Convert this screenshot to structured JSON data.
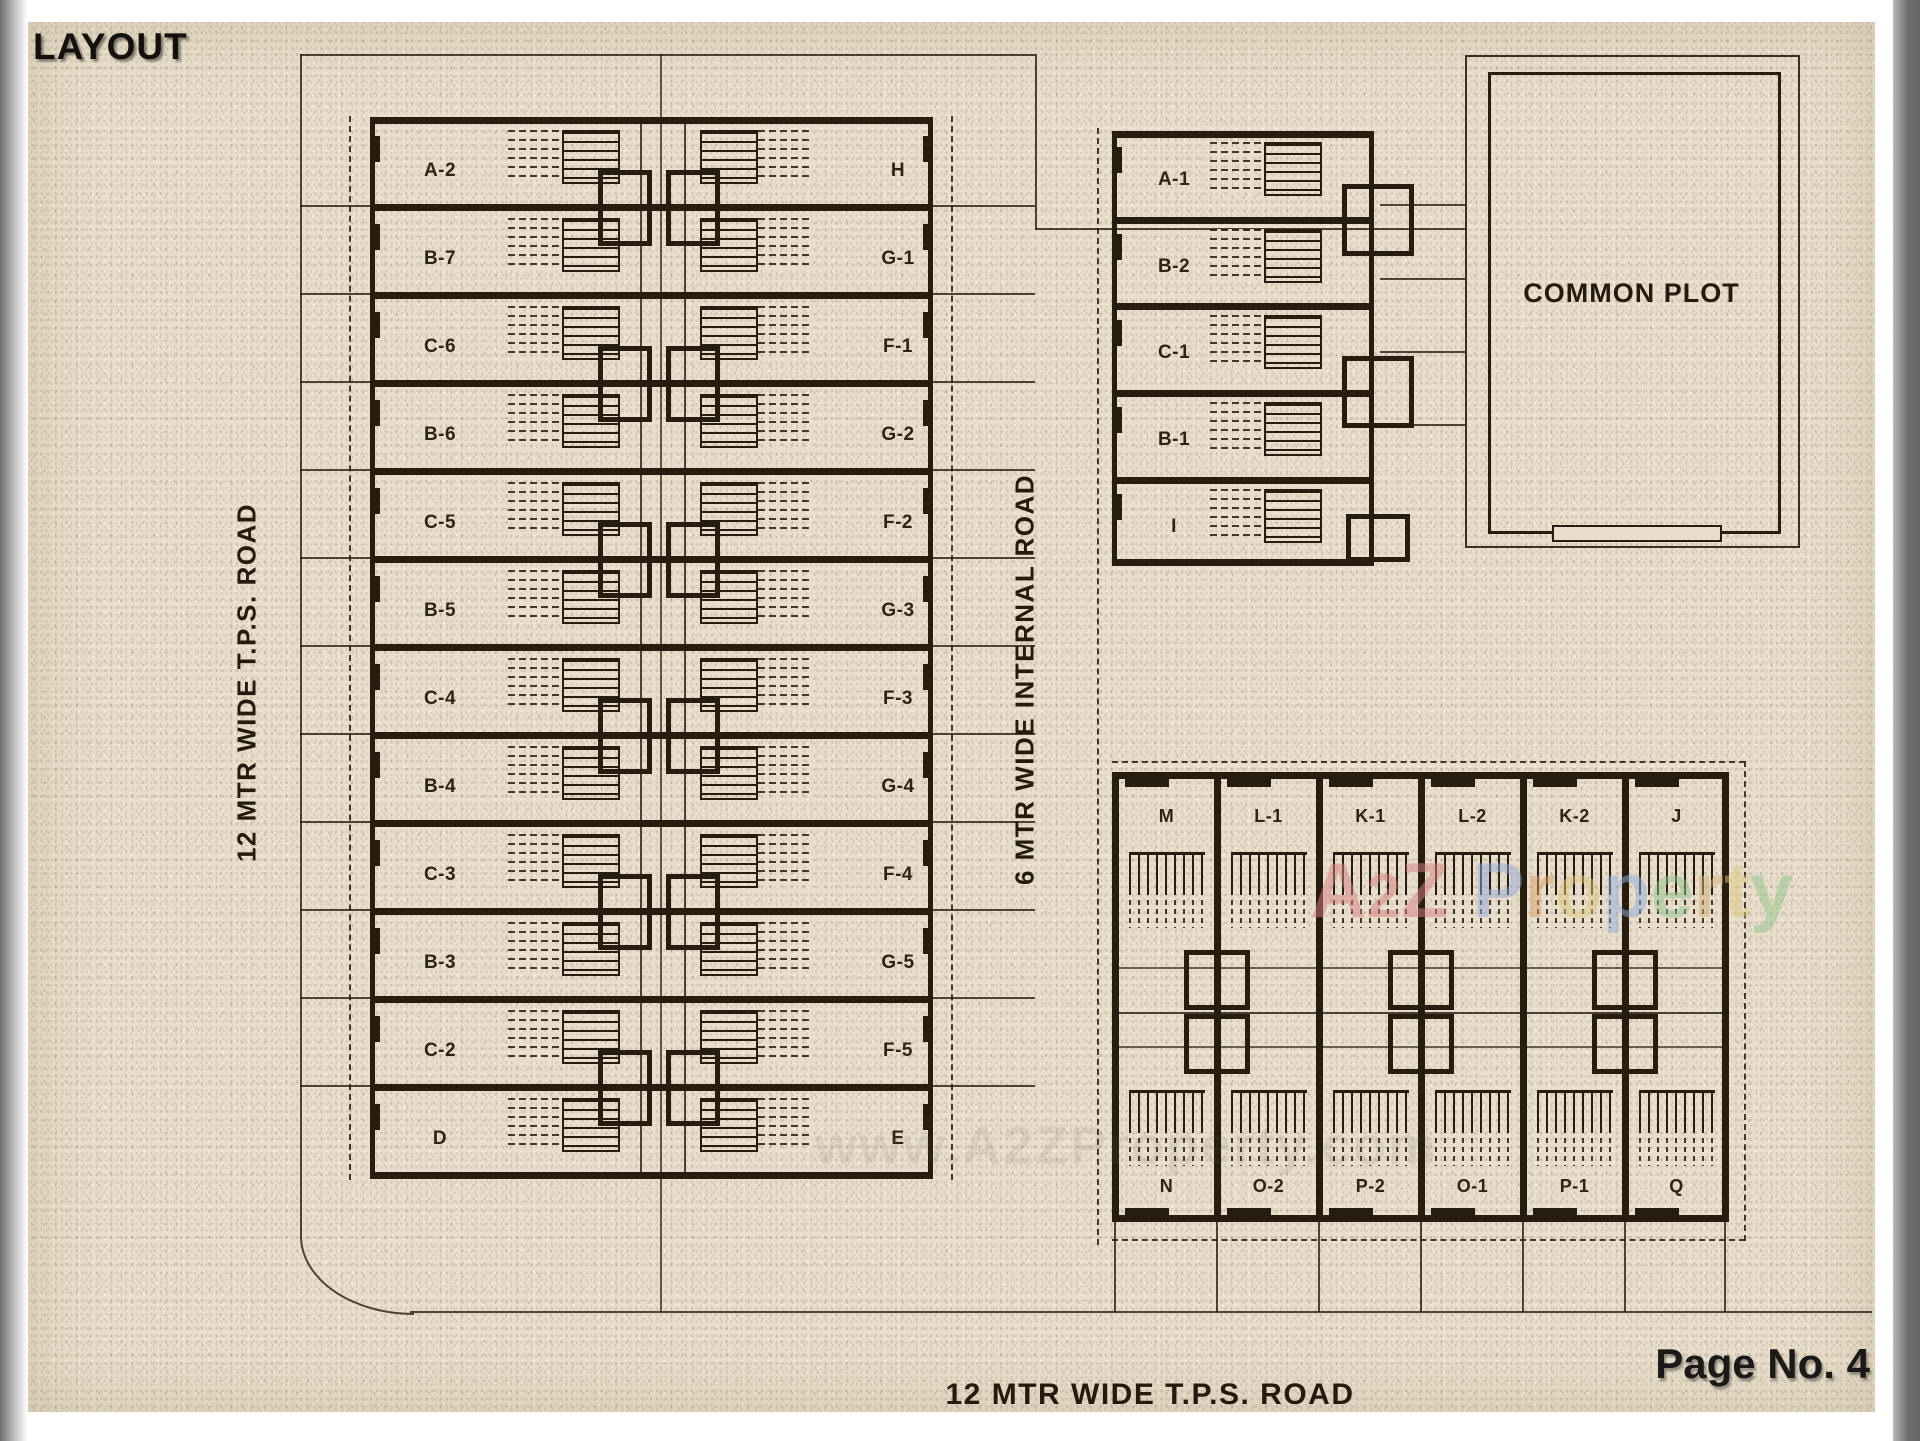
{
  "page": {
    "title": "LAYOUT",
    "page_number": "Page No. 4"
  },
  "roads": {
    "west": "12 MTR WIDE T.P.S. ROAD",
    "internal": "6 MTR WIDE INTERNAL ROAD",
    "south": "12 MTR WIDE T.P.S. ROAD"
  },
  "common_plot": {
    "label": "COMMON PLOT"
  },
  "buildings": {
    "west_block": {
      "west_units": [
        "A-2",
        "B-7",
        "C-6",
        "B-6",
        "C-5",
        "B-5",
        "C-4",
        "B-4",
        "C-3",
        "B-3",
        "C-2",
        "D"
      ],
      "east_units": [
        "H",
        "G-1",
        "F-1",
        "G-2",
        "F-2",
        "G-3",
        "F-3",
        "G-4",
        "F-4",
        "G-5",
        "F-5",
        "E"
      ]
    },
    "north_east_block": {
      "units": [
        "A-1",
        "B-2",
        "C-1",
        "B-1",
        "I"
      ]
    },
    "south_east_block": {
      "top_units": [
        "M",
        "L-1",
        "K-1",
        "L-2",
        "K-2",
        "J"
      ],
      "bottom_units": [
        "N",
        "O-2",
        "P-2",
        "O-1",
        "P-1",
        "Q"
      ]
    }
  },
  "watermark": {
    "letters": [
      {
        "ch": "A",
        "color": "#d67f7f"
      },
      {
        "ch": "2",
        "color": "#d67f7f"
      },
      {
        "ch": "Z",
        "color": "#d88484"
      },
      {
        "ch": " ",
        "color": "#ffffff"
      },
      {
        "ch": "P",
        "color": "#93a9d8"
      },
      {
        "ch": "r",
        "color": "#d8a06a"
      },
      {
        "ch": "o",
        "color": "#ddc87e"
      },
      {
        "ch": "p",
        "color": "#8fb0dd"
      },
      {
        "ch": "e",
        "color": "#90c58e"
      },
      {
        "ch": "r",
        "color": "#d3b07e"
      },
      {
        "ch": "t",
        "color": "#ddc87e"
      },
      {
        "ch": "y",
        "color": "#92c78a"
      }
    ],
    "ghost_text": "www.A2ZProperty.com"
  },
  "colors": {
    "paper": "#e8decb",
    "ink": "#261d10",
    "page_edge": "#6e6e6e"
  }
}
